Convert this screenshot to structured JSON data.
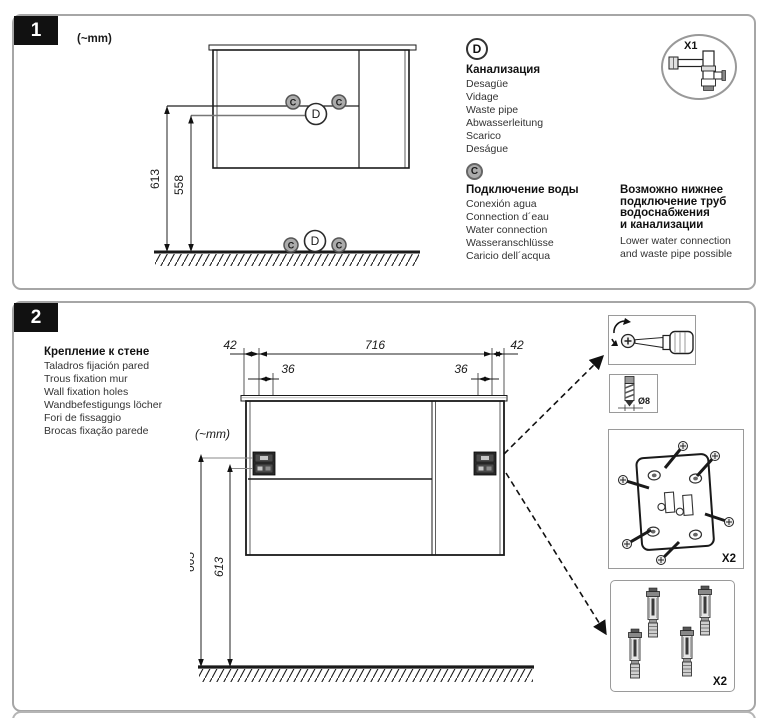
{
  "panel1": {
    "number": "1",
    "units_label": "(~mm)",
    "labels": {
      "c": "C",
      "d": "D"
    },
    "dims": {
      "height_waste": "613",
      "height_water": "558"
    },
    "waste_block": {
      "letter": "D",
      "title": "Канализация",
      "items": [
        "Desagüe",
        "Vidage",
        "Waste pipe",
        "Abwasserleitung",
        "Scarico",
        "Deságue"
      ]
    },
    "water_block": {
      "letter": "C",
      "title": "Подключение воды",
      "items": [
        "Conexión agua",
        "Connection d´eau",
        "Water connection",
        "Wasseranschlüsse",
        "Caricio dell´acqua"
      ]
    },
    "note_block": {
      "title_lines": [
        "Возможно нижнее",
        "подключение труб",
        "водоснабжения",
        "и канализации"
      ],
      "text_lines": [
        "Lower water connection",
        "and waste pipe possible"
      ]
    },
    "siphon_badge": {
      "label": "X1"
    }
  },
  "panel2": {
    "number": "2",
    "units_label": "(~mm)",
    "title_block": {
      "title": "Крепление к стене",
      "items": [
        "Taladros fijación pared",
        "Trous fixation mur",
        "Wall fixation holes",
        "Wandbefestigungs löcher",
        "Fori de fissaggio",
        "Brocas fixação parede"
      ]
    },
    "dims": {
      "offset_left": "42",
      "width": "716",
      "offset_right": "42",
      "hole_spacing_left": "36",
      "hole_spacing_right": "36",
      "height_upper": "665",
      "height_lower": "613"
    },
    "parts": {
      "drill_bit": {
        "diameter": "Ø8"
      },
      "bracket": {
        "count": "X2"
      },
      "anchor": {
        "count": "X2"
      }
    }
  }
}
